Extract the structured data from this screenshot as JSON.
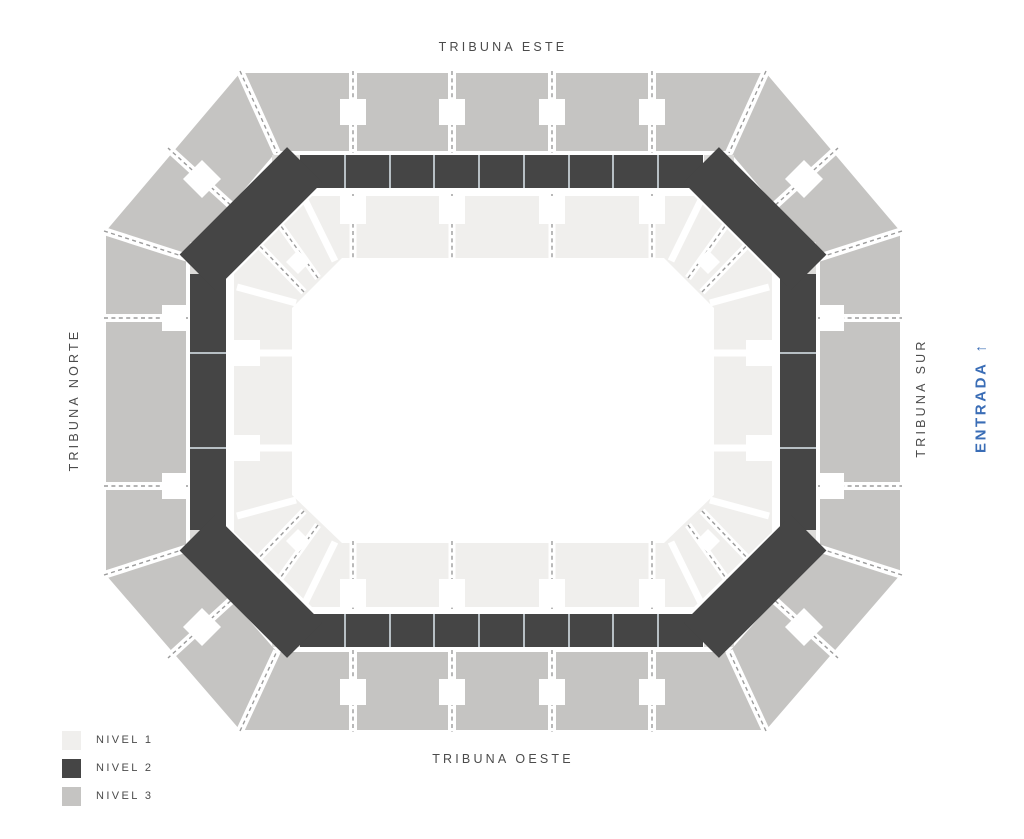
{
  "stands": {
    "east": "TRIBUNA ESTE",
    "north": "TRIBUNA NORTE",
    "south": "TRIBUNA SUR",
    "west": "TRIBUNA OESTE"
  },
  "entrance": {
    "label": "ENTRADA",
    "arrow": "↑"
  },
  "levels": [
    {
      "label": "NIVEL 1",
      "color": "#f0efed"
    },
    {
      "label": "NIVEL 2",
      "color": "#454545"
    },
    {
      "label": "NIVEL 3",
      "color": "#c5c4c2"
    }
  ],
  "colors": {
    "background": "#ffffff",
    "label_text": "#4b4b4b",
    "entrance": "#3a6db6",
    "level1": "#f0efed",
    "level2": "#454545",
    "level3": "#c5c4c2",
    "collar": "#dcdbd9",
    "divider_dash": "#9b9b9b",
    "segment_line": "#b7bfc4"
  }
}
